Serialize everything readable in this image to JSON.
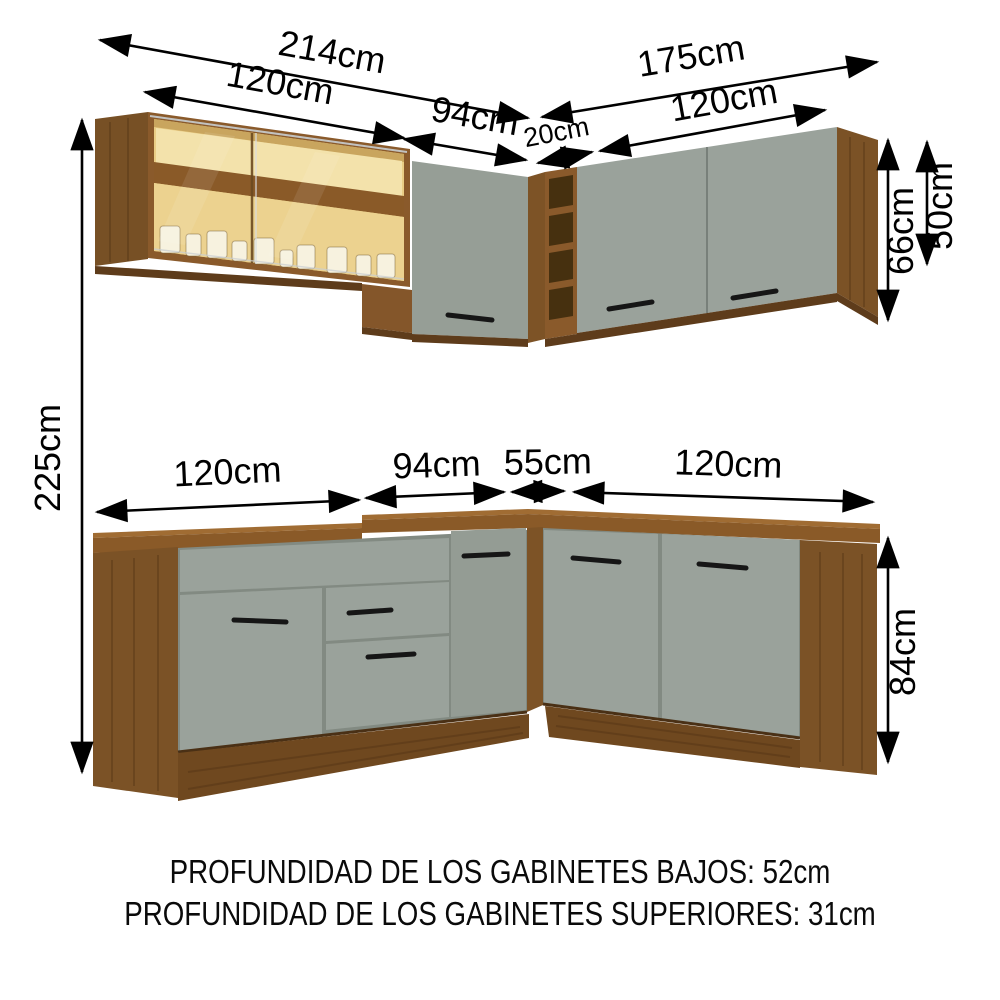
{
  "title": "Cocina integral esquinera - diagrama de dimensiones",
  "dimensions": {
    "upper_left_total": "214cm",
    "upper_right_total": "175cm",
    "upper_left_glass": "120cm",
    "upper_left_corner": "94cm",
    "upper_corner_shelf": "20cm",
    "upper_right_doors": "120cm",
    "upper_cabinet_height": "66cm",
    "upper_glass_height": "50cm",
    "total_height": "225cm",
    "lower_left": "120cm",
    "lower_left_corner": "94cm",
    "lower_corner": "55cm",
    "lower_right": "120cm",
    "base_height": "84cm"
  },
  "footer": {
    "line1": "PROFUNDIDAD DE LOS GABINETES BAJOS: 52cm",
    "line2": "PROFUNDIDAD DE LOS GABINETES SUPERIORES: 31cm"
  },
  "colors": {
    "wood": "#8a5a2b",
    "wood_panel": "#7b5226",
    "wood_dark": "#5e3c1b",
    "wood_plinth": "#6f481f",
    "wood_counter_top": "#a06c33",
    "door_gray": "#9aa29b",
    "glass_amber": "#e9cd86",
    "handle": "#161616",
    "annotation": "#000000"
  }
}
